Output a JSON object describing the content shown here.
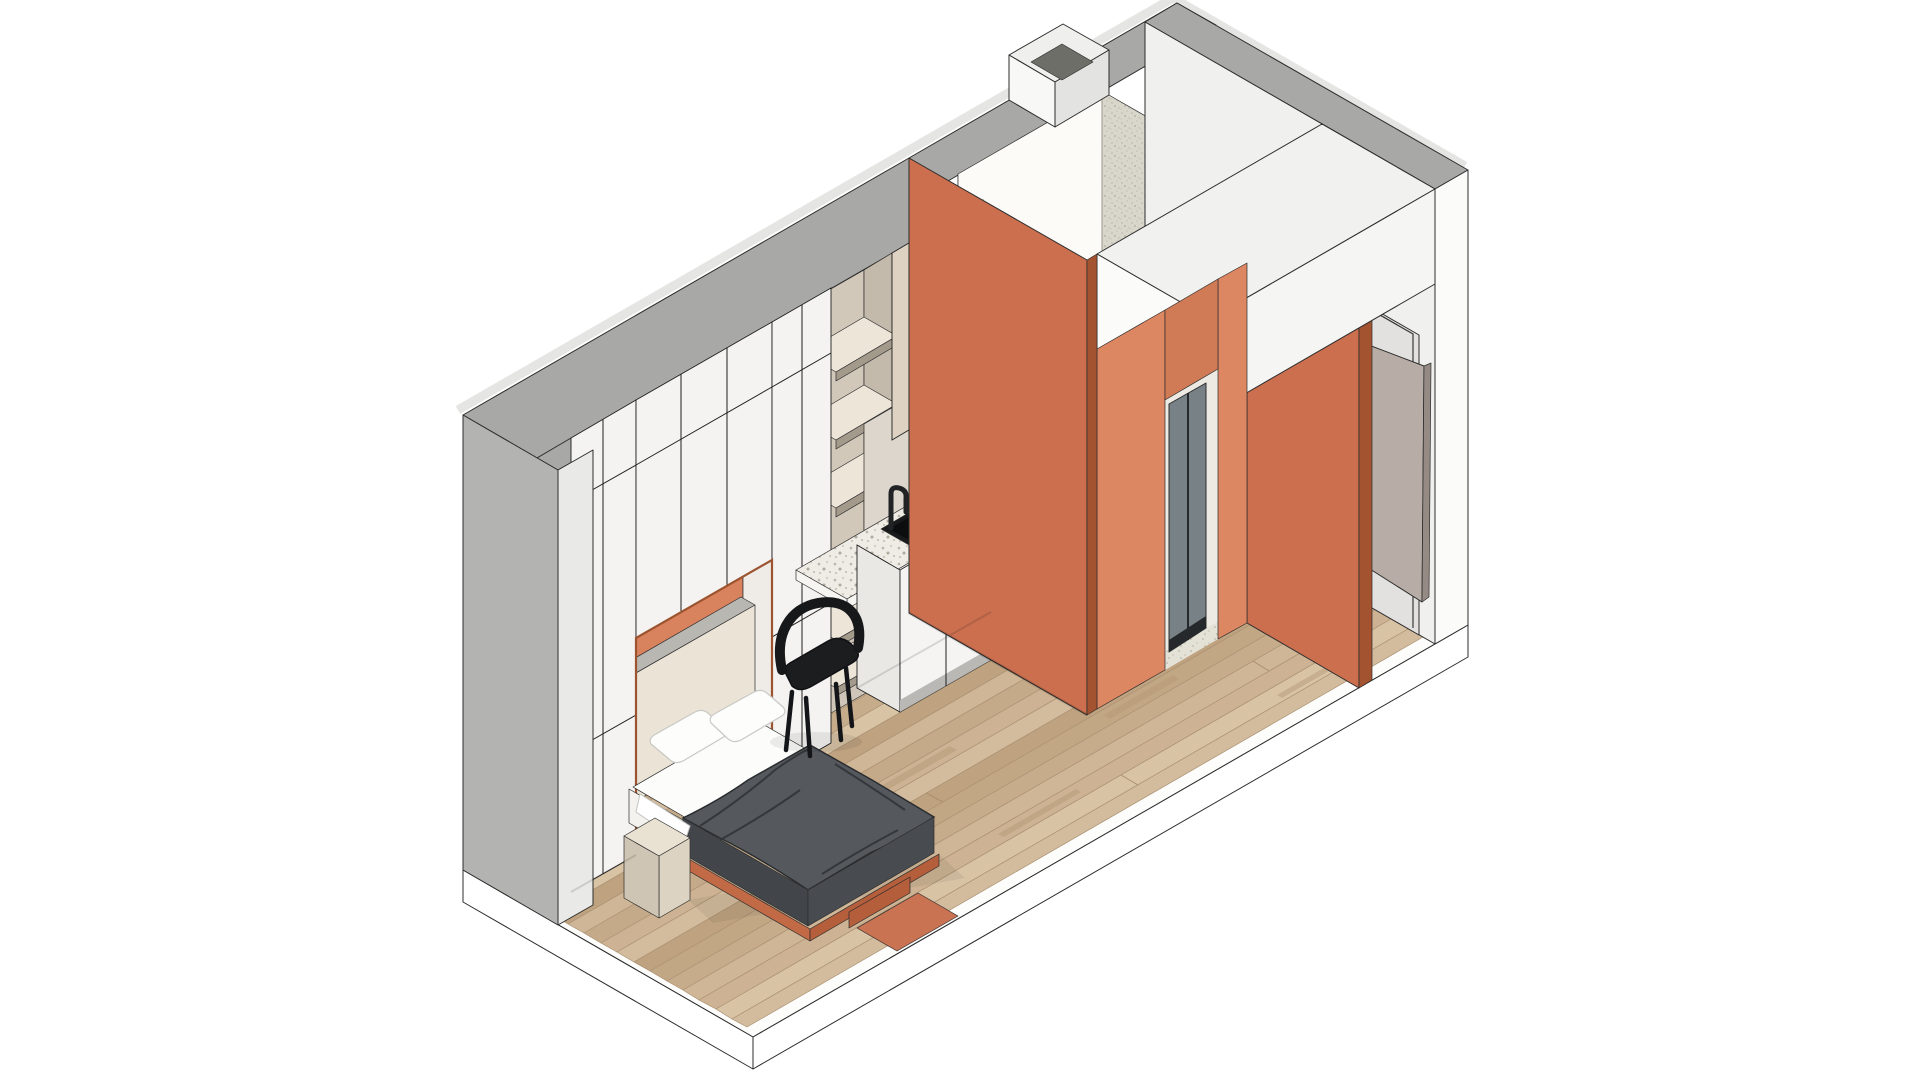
{
  "scene": {
    "type": "isometric-architectural-rendering",
    "subject": "micro studio apartment cutaway with murphy bed, kitchenette, bathroom pod and entry",
    "background": "#ffffff"
  },
  "colors": {
    "outline": "#2d2d2d",
    "wall_top_band": "#a8a8a7",
    "wall_top_light": "#e5e5e4",
    "left_wall": "#b3b3b2",
    "wall_cut": "#e9e9e8",
    "cabinet_front": "#f4f3f1",
    "beige_door": "#ded3c2",
    "shelf_back": "#d2c8ba",
    "shelf_top": "#ece5d8",
    "shelf_edge": "#a39a8c",
    "shelf_side": "#c4baab",
    "splashback": "#dcd6cd",
    "counter_base": "#efece6",
    "counter_front": "#f7f5f1",
    "sink": "#191a1c",
    "sink_inner": "#0c0d0e",
    "base_cabinet": "#f5f4f2",
    "base_end": "#e9e8e5",
    "kick": "#b9b8b5",
    "desk_back": "#cfc6b9",
    "niche_orange": "#d8825e",
    "niche_soffit": "#d9d6d2",
    "niche_reveal": "#efece8",
    "niche_trim": "#9c532f",
    "headboard": "#eae3d6",
    "headboard_top": "#b9b7b2",
    "sheet": "#fcfcfb",
    "sheet_side": "#f3f2ef",
    "duvet_top": "#55595d",
    "duvet_side": "#42464a",
    "duvet_foot": "#484c50",
    "bedframe": "#c26a46",
    "bedframe_dark": "#b45e3b",
    "bed_pad": "#c97352",
    "nightstand_top": "#e9e1d2",
    "nightstand_front": "#ddd3c2",
    "nightstand_side": "#cfc5b4",
    "chair": "#1c1d1f",
    "orange_wall": "#cb6f4f",
    "orange_wall_bright": "#dd8662",
    "orange_wall_dark": "#a3532f",
    "orange_header": "#d07a56",
    "orange_top": "#e3a586",
    "pod_interior": "#f7f6f1",
    "pod_back": "#fcfbf7",
    "pod_speckle": "#d9d6cb",
    "sky_top": "#efefed",
    "sky_front": "#f8f8f6",
    "sky_side": "#e3e3e1",
    "sky_opening": "#6e6e68",
    "soffit_top": "#f1f1ef",
    "soffit_face": "#fbfbf9",
    "soffit_front": "#f5f5f3",
    "right_wall": "#f0f0ef",
    "recess": "#e2e1df",
    "wall_sliver": "#fbfbfa",
    "door_leaf": "#b7ada6",
    "door_edge": "#958b84",
    "glass": "#778186",
    "glass_frame": "#26292b",
    "bath_floor": "#e4e1d7",
    "bath_wall": "#eceae3",
    "slab_side": "#ffffff",
    "slab_top": "#fdfdfc"
  },
  "floor": {
    "plank_tones": [
      "#cdb393",
      "#c2a785",
      "#d3bb9d",
      "#c7ac8b",
      "#d8c3a5",
      "#bfa380",
      "#cfb697",
      "#c5aa89"
    ]
  }
}
